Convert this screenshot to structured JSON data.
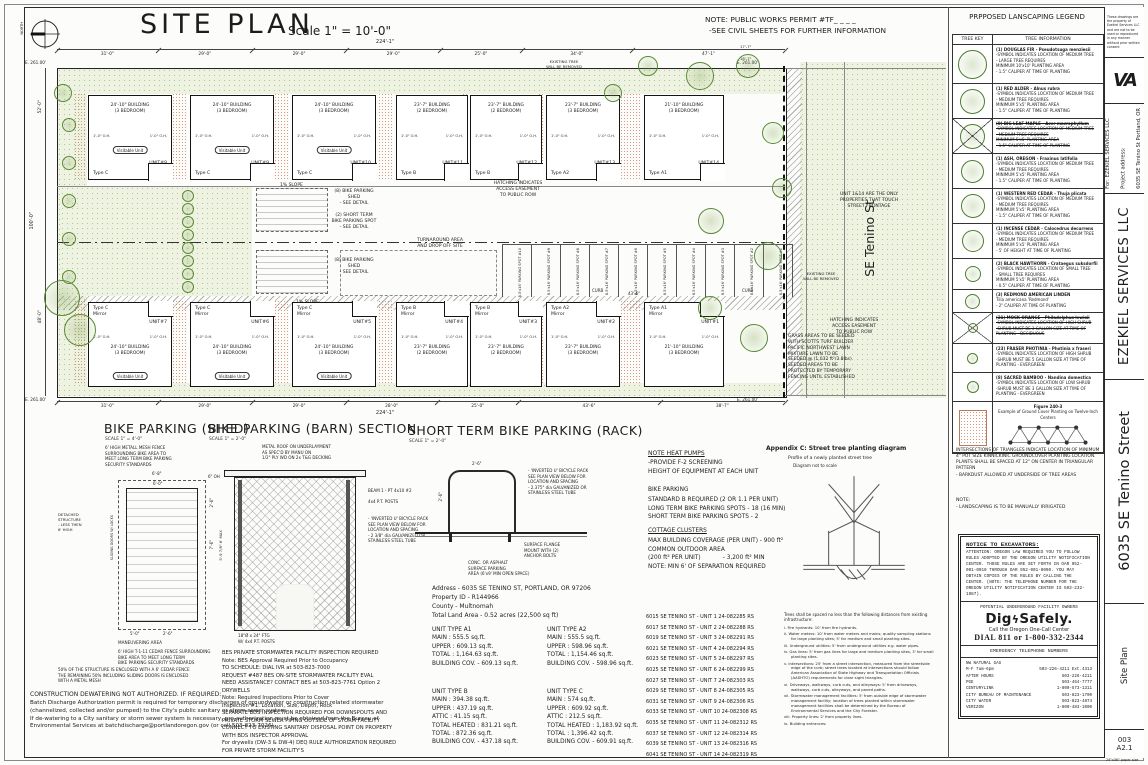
{
  "sheet": {
    "title": "SITE PLAN",
    "scale": "Scale 1\" = 10'-0\"",
    "north": "NORTH",
    "note1": "NOTE: PUBLIC WORKS PERMIT #TF_ _ _ _",
    "note2": "-SEE CIVIL SHEETS FOR FURTHER INFORMATION",
    "paper": "24\"x36\" paper size"
  },
  "titleblock": {
    "disclaimer": "These drawings are the property of Ezekiel Services LLC and are not to be used or reproduced in any manner without prior written consent",
    "logo": "VA",
    "for_line": "For: EZEKIEL SERVICES LLC",
    "project_label": "Project address:",
    "project_address": "6035 SE Tenino St Portland, OR",
    "company": "EZEKIEL SERVICES LLC",
    "street": "6035 SE Tenino Street",
    "sheet_name": "Site Plan",
    "sheet_no": "003",
    "sheet_code": "A2.1"
  },
  "plan": {
    "elevation": "E. 261.00'",
    "street_label": "SE Tenino St",
    "total_top": "224'-1\"",
    "total_bottom": "224'-1\"",
    "seg_dims_top": [
      "31'-0\"",
      "29'-0\"",
      "29'-0\"",
      "29'-0\"",
      "25'-0\"",
      "34'-0\"",
      "47'-1\""
    ],
    "seg_dims_bottom": [
      "31'-0\"",
      "29'-0\"",
      "29'-0\"",
      "28'-0\"",
      "25'-0\"",
      "43'-6\"",
      "38'-7\""
    ],
    "left_upper": "52'-0\"",
    "left_total": "100'-0\"",
    "left_lower": "48'-0\"",
    "dim_43": "43'-6\"",
    "dim_r1": "17'-7\"",
    "dim_r2": "18'-7\"",
    "oh": "1'-0\" O.H.",
    "visitable": "Visitable Unit",
    "mirror_label": "Mirror",
    "curb": "CURB",
    "buildings_top": [
      {
        "unit": "UNIT#8",
        "type": "Type C",
        "mirror": false,
        "w": "24'-10\" BUILDING",
        "beds": "(3 BEDROOM)",
        "visitable": true
      },
      {
        "unit": "UNIT#9",
        "type": "Type C",
        "mirror": false,
        "w": "24'-10\" BUILDING",
        "beds": "(3 BEDROOM)",
        "visitable": true
      },
      {
        "unit": "UNIT#10",
        "type": "Type C",
        "mirror": false,
        "w": "24'-10\" BUILDING",
        "beds": "(3 BEDROOM)",
        "visitable": true
      },
      {
        "unit": "UNIT#11",
        "type": "Type B",
        "mirror": false,
        "w": "23'-7\" BUILDING",
        "beds": "(2 BEDROOM)",
        "visitable": false
      },
      {
        "unit": "UNIT#12",
        "type": "Type B",
        "mirror": false,
        "w": "23'-7\" BUILDING",
        "beds": "(2 BEDROOM)",
        "visitable": false
      },
      {
        "unit": "UNIT#13",
        "type": "Type A2",
        "mirror": false,
        "w": "23'-7\" BUILDING",
        "beds": "(3 BEDROOM)",
        "visitable": false
      },
      {
        "unit": "UNIT#14",
        "type": "Type A1",
        "mirror": false,
        "w": "21'-10\" BUILDING",
        "beds": "(3 BEDROOM)",
        "visitable": false
      }
    ],
    "buildings_bottom": [
      {
        "unit": "UNIT#7",
        "type": "Type C",
        "mirror": true,
        "w": "24'-10\" BUILDING",
        "beds": "(3 BEDROOM)",
        "visitable": true
      },
      {
        "unit": "UNIT#6",
        "type": "Type C",
        "mirror": true,
        "w": "24'-10\" BUILDING",
        "beds": "(3 BEDROOM)",
        "visitable": true
      },
      {
        "unit": "UNIT#5",
        "type": "Type C",
        "mirror": true,
        "w": "24'-10\" BUILDING",
        "beds": "(3 BEDROOM)",
        "visitable": true
      },
      {
        "unit": "UNIT#4",
        "type": "Type B",
        "mirror": true,
        "w": "23'-7\" BUILDING",
        "beds": "(2 BEDROOM)",
        "visitable": false
      },
      {
        "unit": "UNIT#3",
        "type": "Type B",
        "mirror": true,
        "w": "23'-7\" BUILDING",
        "beds": "(2 BEDROOM)",
        "visitable": false
      },
      {
        "unit": "UNIT#2",
        "type": "Type A2",
        "mirror": true,
        "w": "23'-7\" BUILDING",
        "beds": "(3 BEDROOM)",
        "visitable": false
      },
      {
        "unit": "UNIT#1",
        "type": "Type A1",
        "mirror": true,
        "w": "21'-10\" BUILDING",
        "beds": "(3 BEDROOM)",
        "visitable": false
      }
    ],
    "parking": [
      "8.5'x16' PARKING SPOT #10",
      "8.5'x16' PARKING SPOT #9",
      "8.5'x16' PARKING SPOT #8",
      "8.5'x16' PARKING SPOT #7",
      "8.5'x16' PARKING SPOT #6",
      "8.5'x16' PARKING SPOT #5",
      "8.5'x16' PARKING SPOT #4",
      "8.5'x16' PARKING SPOT #3",
      "8.5'x16' PARKING SPOT #2",
      "8.5'x16' PARKING SPOT #1"
    ],
    "notes": {
      "slope": "1% SLOPE",
      "shed": "(8) BIKE PARKING\nSHED\n- SEE DETAIL",
      "short_term": "(2) SHORT TERM\nBIKE PARKING SPOT\n- SEE DETAIL",
      "turnaround": "TURNAROUND AREA\nAND DROP OFF SITE",
      "easement": "HATCHING INDICATES\nACCESS EASEMENT\nTO PUBLIC ROW",
      "frontage": "UNIT 1&14 ARE THE ONLY\nPROPERTIES THAT TOUCH\nSTREET FRONTAGE",
      "existing_tree": "EXISTING TREE\nWILL BE REMOVED",
      "grass": "GRASS AREAS TO BE SEEDED\nWITH SCOTTS TURF BUILDER\nPACIFIC NORTHWEST LAWN\nMIXTURE LAWN TO BE\nSEEDED @ (1,032 ft²/3.8lbs)\nSEEDED AREAS TO BE\nPROTECTED BY TEMPORARY\nFENCING UNTIL ESTABLISHED"
    }
  },
  "details": {
    "shed": {
      "title": "BIKE PARKING (SHED)",
      "scale": "SCALE 1\" = 4'-0\"",
      "fence_note": "6' HIGH METALL MESH FENCE\nSURROUNDING BIKE AREA TO\nMEET LONG TERM BIKE PARKING\nSECURITY STANDARDS",
      "detached": "DETACHED\nSTRUCTURE\n- LESS THEN\n6' HIGH",
      "sliding": "SLIDING DOORS W/ LOCKS",
      "maneuvering": "MANEUVERING AREA",
      "cedar_note": "6' HIGH T-1-11 CEDAR FENCE SURROUNDING\nBIKE AREA TO MEET LONG TERM\nBIKE PARKING SECURITY STANDARDS",
      "enclosure_note": "50% OF THE STRUCTURE IS ENCLOSED WITH A 6' CEDAR FENCE\nTHE REMAINING 50% INCLUDING SLIDING DOORS IS ENCLOSED\nWITH A METAL MESH",
      "dim_w": "6'-8\"",
      "dim_w2": "6'-0\"",
      "dim_oh": "6\" OH",
      "dim_r1": "2'-6\"",
      "dim_r2": "7'-6\"",
      "dim_b1": "5'-0\"",
      "dim_b2": "2'-6\""
    },
    "barn": {
      "title": "BIKE PARKING (BARN) SECTION",
      "scale": "SCALE 1\" = 2'-0\"",
      "roof_note": "METAL ROOF ON UNDERLAYMENT\nAS SPEC'D BY MANU ON\n1/2\" PLY WD ON 2x T&G DECKING",
      "beam": "BEAM 1 - PT 4x10 #2",
      "posts": "4x4 P.T. POSTS",
      "rack_note": "- 'INVERTED U' BICYCLE RACK\nSEE PLAN VIEW BELOW FOR\nLOCATION AND SPACING\n- 2 3/8\" dia GALVANIZED OR\nSTAINLESS STEEL TUBE",
      "height": "5'-9 7/8\"  6' MAX",
      "footing": "18\"Ø x 24\" FTG\nW/ 4x4 P.T. POSTS"
    },
    "rack": {
      "title": "SHORT TERM BIKE PARKING (RACK)",
      "scale": "SCALE 1\" = 2'-0\"",
      "rack_note": "- 'INVERTED U' BICYCLE RACK\nSEE PLAN VIEW BELOW FOR\nLOCATION AND SPACING\n- 2.375\" dia GALVANIZED OR\nSTAINLESS STEEL TUBE",
      "flange_note": "SURFACE FLANGE\nMOUNT WITH (2)\nANCHOR BOLTS",
      "surface_note": "CONC. OR ASPHALT\nSURFACE PARKING\nAREA (6'x9' MIN OPEN SPACE)",
      "dim_w": "2'-6\"",
      "dim_h": "2'-6\""
    }
  },
  "property": {
    "address": "Address - 6035 SE TENINO ST, PORTLAND, OR 97206",
    "property_id": "Property ID - R144966",
    "county": "County - Multnomah",
    "land": "Total Land Area - 0.52 acres (22,500 sq ft)"
  },
  "unit_types": [
    {
      "name": "UNIT TYPE A1",
      "lines": [
        "MAIN : 555.5 sq.ft.",
        "UPPER : 609.13 sq.ft.",
        "TOTAL : 1,164.63 sq.ft.",
        "BUILDING COV. - 609.13 sq.ft."
      ]
    },
    {
      "name": "UNIT TYPE A2",
      "lines": [
        "MAIN : 555.5 sq.ft.",
        "UPPER : 598.96 sq.ft.",
        "TOTAL : 1,154.46 sq.ft.",
        "BUILDING COV. - 598.96 sq.ft."
      ]
    },
    {
      "name": "UNIT TYPE B",
      "lines": [
        "MAIN : 394.38 sq.ft.",
        "UPPER : 437.19 sq.ft.",
        "ATTIC : 41.15 sq.ft.",
        "TOTAL HEATED : 831.21 sq.ft.",
        "TOTAL : 872.36 sq.ft.",
        "BUILDING COV. - 437.18 sq.ft."
      ]
    },
    {
      "name": "UNIT TYPE C",
      "lines": [
        "MAIN : 574 sq.ft.",
        "UPPER : 609.92 sq.ft.",
        "ATTIC : 212.5 sq.ft.",
        "TOTAL HEATED : 1,183.92 sq.ft.",
        "TOTAL : 1,396.42 sq.ft.",
        "BUILDING COV. - 609.91 sq.ft."
      ]
    }
  ],
  "site_notes": {
    "heat_title": "NOTE HEAT PUMPS",
    "heat": "-PROVIDE F-2 SCREENING\nHEIGHT OF EQUIPMENT AT EACH UNIT",
    "bike_title": "BIKE PARKING",
    "bike": "STANDARD B REQUIRED (2 OR 1.1 PER UNIT)\nLONG TERM BIKE PARKING SPOTS - 18 (16 MIN)\nSHORT TERM BIKE PARKING SPOTS - 2",
    "cottage_title": "COTTAGE CLUSTERS",
    "cottage": "MAX BUILDING COVERAGE (PER UNIT) - 900 ft²\nCOMMON OUTDOOR AREA\n(200 ft² PER UNIT)            - 3,200 ft² MIN\nNOTE: MIN 6' OF SEPARATION REQUIRED"
  },
  "addresses": [
    "6015 SE TENINO ST - UNIT 1  24-082285 RS",
    "6017 SE TENINO ST - UNIT 2  24-082288 RS",
    "6019 SE TENINO ST - UNIT 3  24-082291 RS",
    "6021 SE TENINO ST - UNIT 4  24-082294 RS",
    "6023 SE TENINO ST - UNIT 5  24-082297 RS",
    "6025 SE TENINO ST - UNIT 6  24-082299 RS",
    "6027 SE TENINO ST - UNIT 7  24-082303 RS",
    "6029 SE TENINO ST - UNIT 8  24-082305 RS",
    "6031 SE TENINO ST - UNIT 9  24-082306 RS",
    "6033 SE TENINO ST - UNIT 10  24-082308 RS",
    "6035 SE TENINO ST - UNIT 11  24-082312 RS",
    "6037 SE TENINO ST - UNIT 12  24-082314 RS",
    "6039 SE TENINO ST - UNIT 13  24-082316 RS",
    "6041 SE TENINO ST - UNIT 14  24-082319 RS"
  ],
  "appendix": {
    "title": "Appendix C: Street tree planting diagram",
    "sub1": "Profile of a newly planted street tree",
    "sub2": "Diagram not to scale",
    "intro": "Trees shall be spaced no less than the following distances from existing infrastructure:",
    "items": [
      "i.  Fire hydrants: 10' from fire hydrants.",
      "ii.  Water meters: 10' from water meters and mains; quality sampling stations for large planting sites; 5' for medium and small planting sites.",
      "iii.  Underground utilities: 5' from underground utilities e.g. water pipes.",
      "iv.  Gas lines: 5' from gas lines for large and medium planting sites, 3' for small planting sites.",
      "v.  Intersections: 25' from a street intersection, measured from the streetside edge of the curb; street trees located at intersections should follow American Association of State Highway and Transportation Officials (AASHTO) requirements for clear sight triangles.",
      "vi.  Driveways, walkways, curb cuts, and alleyways: 5' from driveways, walkways, curb cuts, alleyways, and paved paths.",
      "vii.  Stormwater management facilities: 5' from outside edge of stormwater management facility; location of trees planted within stormwater management facilities shall be determined by the Bureau of Environmental Services and the City Forester.",
      "viii.  Property lines: 2' from property lines.",
      "ix.  Building entrances:"
    ]
  },
  "construction": {
    "title": "CONSTRUCTION DEWATERING NOT AUTHORIZED. IF REQUIRED:",
    "body": "Batch Discharge Authorization permit is required for temporary discharges of groundwater or construction related stormwater (channelized, collected and/or pumped) to the City's public sanitary or storm sewer system.\nIf de-watering to a City sanitary or storm sewer system is necessary, pre-authorization must be obtained from the Bureau of Environmental Services at batchdischarge@portlandoregon.gov (or call 503-823-7026)."
  },
  "bes": "BES PRIVATE STORMWATER FACILITY INSPECTION REQUIRED\nNote: BES Approval Required Prior to Occupancy\nTO SCHEDULE: DIAL IVR at 503-823-7000\nREQUEST #487 BES ON-SITE STORMWATER FACILITY EVAL\nNEED ASSISTANCE? CONTACT BES at 503-823-7761 Option 2\nDRYWELLS\nNote: Required Inspections Prior to Cover\nInspection #1: Location, Size, Depth, Rock\nSEPARATE BDS INSPECTION REQUIRED FOR DOWNSPOUTS AND\nPRIVATE STORM SEWER PIPING OUTSIDE OF STORM FACILITY\nCONNECT TO EXISTING SANITARY DISPOSAL POINT ON PROPERTY\nWITH BDS INSPECTOR APPROVAL\nFor drywells (DW-3 & DW-4) DEQ RULE AUTHORIZATION REQUIRED\nFOR PRIVATE STORM FACILITY'S",
  "legend": {
    "title": "PRPPOSED LANSCAPING LEGEND",
    "col1": "TREE KEY",
    "col2": "TREE INFORMATION",
    "rows": [
      {
        "name": "(1) DOUGLAS FIR - Pseudotsuga menziesii",
        "lines": [
          "-SYMBOL INDICATES LOCATION OF MEDIUM TREE",
          "- LARGE TREE REQUIRES",
          "MINIMUM 10'x10' PLANTING AREA",
          "- 1.5\" CALIPER AT TIME OF PLANTING"
        ],
        "struck": false
      },
      {
        "name": "(1) RED ALDER - Alnus rubra",
        "lines": [
          "-SYMBOL INDICATES LOCATION OF MEDIUM TREE",
          "- MEDIUM TREE REQUIRES",
          "MINIMUM 5'x5' PLANTING AREA",
          "- 1.5\" CALIPER AT TIME OF PLANTING"
        ],
        "struck": false
      },
      {
        "name": "(0) BIG LEAF MAPLE - Acer macrophyllum",
        "lines": [
          "-SYMBOL INDICATES LOCATION OF MEDIUM TREE",
          "- MEDIUM TREE REQUIRES",
          "MINIMUM 5'x5' PLANTING AREA",
          "- 1.5\" CALIPER AT TIME OF PLANTING"
        ],
        "struck": true
      },
      {
        "name": "(1) ASH, OREGON - Fraxinus latifolia",
        "lines": [
          "-SYMBOL INDICATES LOCATION OF MEDIUM TREE",
          "- MEDIUM TREE REQUIRES",
          "MINIMUM 5'x5' PLANTING AREA",
          "- 1.5\" CALIPER AT TIME OF PLANTING"
        ],
        "struck": false
      },
      {
        "name": "(1) WESTERN RED CEDAR - Thuja plicata",
        "lines": [
          "-SYMBOL INDICATES LOCATION OF MEDIUM TREE",
          "- MEDIUM TREE REQUIRES",
          "MINIMUM 5'x5' PLANTING AREA",
          "- 1.5\" CALIPER AT TIME OF PLANTING"
        ],
        "struck": false
      },
      {
        "name": "(1) INCENSE CEDAR - Calocedrus decurrens",
        "lines": [
          "-SYMBOL INDICATES LOCATION OF MEDIUM TREE",
          "- MEDIUM TREE REQUIRES",
          "MINIMUM 5'x5' PLANTING AREA",
          "- 5' OF HEIGHT AT TIME OF PLANTING"
        ],
        "struck": false
      },
      {
        "name": "(2) BLACK HAWTHORN - Crataegus suksdorfii",
        "lines": [
          "-SYMBOL INDICATES LOCATION OF SMALL TREE",
          "- SMALL TREE REQUIRES",
          "MINIMUM 5'x5' PLANTING AREA",
          "- 0.5\" CALIPER AT TIME OF PLANTING"
        ],
        "struck": false
      },
      {
        "name": "(3) REDMOND AMERICAN LINDEN",
        "lines": [
          "Tilia americana 'Redmond'",
          "- 2\" CALIPER AT TIME OF PLANTING"
        ],
        "struck": false
      },
      {
        "name": "(21) MOCK ORANGE - Philadelphus lewisii",
        "lines": [
          "-SYMBOL INDICATES LOCATION OF HIGH SHRUB",
          "-SHRUB MUST BE 3 GALLON SIZE AT TIME OF",
          "PLANTING - DECIDUOUS"
        ],
        "struck": true
      },
      {
        "name": "(23) FRASER PHOTINIA - Photinia x fraseri",
        "lines": [
          "-SYMBOL INDICATES LOCATION OF HIGH SHRUB",
          "-SHRUB MUST BE 5 GALLON SIZE AT TIME OF",
          "PLANTING - EVERGREEN"
        ],
        "struck": false
      },
      {
        "name": "(8) SACRED BAMBOO - Nandina domestica",
        "lines": [
          "-SYMBOL INDICATES LOCATION OF LOW SHRUB",
          "-SHRUB MUST BE 3 GALLON SIZE AT TIME OF",
          "PLANTING - EVERGREEN"
        ],
        "struck": false
      },
      {
        "name": "Figure 240-3",
        "lines": [
          "Example of Ground Cover Planting on Twelve-Inch Centers"
        ],
        "struck": false,
        "figure": true
      }
    ],
    "groundcover_note": "INTERSECTIONS OF TRIANGLES INDICATE LOCATION OF MINIMUM 4\" POT SIZE KINNICKINIC GROUNDCOVER PLANTING LOCATION. PLANTS SHALL BE SPACED AT 12\" ON CENTER IN TRIANGULAR PATTERN\n- BARKDUST ALLOWED AT UNDERSIDE OF TREE AREAS",
    "note_title": "NOTE:",
    "note_line": "- LANDSCAPING IS TO BE MANUALLY IRRIGATED"
  },
  "excavators": {
    "title": "NOTICE TO EXCAVATORS:",
    "body": "ATTENTION: OREGON LAW REQUIRES YOU TO FOLLOW RULES ADOPTED BY THE OREGON UTILITY NOTIFICATION CENTER. THOSE RULES ARE SET FORTH IN OAR 952-001-0010 THROUGH OAR 952-001-0090. YOU MAY OBTAIN COPIES OF THE RULES BY CALLING THE CENTER. (NOTE: THE TELEPHONE NUMBER FOR THE OREGON UTILITY NOTIFICATION CENTER IS 503-232-1987).",
    "owners": "POTENTIAL UNDERGROUND FACILITY OWNERS",
    "logo_part1": "Dig",
    "logo_bolt": "ϟ",
    "logo_part2": "Safely.",
    "call": "Call the Oregon One-Call Center",
    "dial": "DIAL  811  or  1-800-332-2344",
    "emergency_title": "EMERGENCY TELEPHONE NUMBERS",
    "rows": [
      {
        "label": "NW NATURAL GAS",
        "number": ""
      },
      {
        "label": "   M-F 7am-6pm",
        "number": "503-226-4211 Ext.4313"
      },
      {
        "label": "   AFTER HOURS",
        "number": "503-226-4211"
      },
      {
        "label": "PGE",
        "number": "503-464-7777"
      },
      {
        "label": "CENTURYLINK",
        "number": "1-800-573-1311"
      },
      {
        "label": "CITY BUREAU OF MAINTENANCE",
        "number": "503-823-1700"
      },
      {
        "label": "CITY WATER",
        "number": "503-823-4874"
      },
      {
        "label": "VERIZON",
        "number": "1-800-483-1000"
      }
    ]
  }
}
